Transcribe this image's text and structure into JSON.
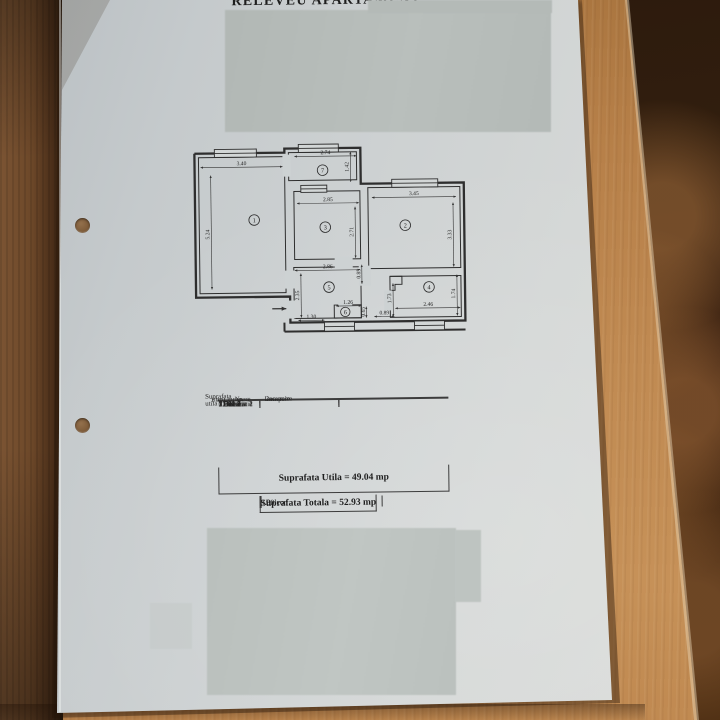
{
  "title": "RELEVEU APARTAMENT",
  "plan": {
    "rooms": {
      "r1": "1",
      "r2": "2",
      "r3": "3",
      "r4": "4",
      "r5": "5",
      "r6": "6",
      "r7": "7"
    },
    "dims": {
      "camera1_w": "3.40",
      "camera1_h": "5.24",
      "balcon_w": "2.74",
      "balcon_h": "1.42",
      "bucatarie_w": "2.85",
      "bucatarie_h": "2.71",
      "camera2_w": "3.45",
      "camera2_h": "3.33",
      "hol_w": "2.86",
      "hol_h": "2.35",
      "hol_door": "0.85",
      "debara_w": "1.26",
      "debara_h": "0.65",
      "debara_off": "1.30",
      "baie_door": "0.89",
      "baie_w": "2.46",
      "baie_hl": "1.73",
      "baie_hr": "1.74"
    }
  },
  "table": {
    "headers": {
      "col1_line1": "Nr.",
      "col1_line2": "incapere",
      "col2_line1": "Denumire",
      "col2_line2": "incapere",
      "col3_line1": "Suprafata utila",
      "col3_line2": "(mp)"
    },
    "rows": [
      {
        "nr": "1",
        "name": "Camera 1",
        "area": "17.81"
      },
      {
        "nr": "2",
        "name": "Camera 2",
        "area": "11.48"
      },
      {
        "nr": "3",
        "name": "Bucatarie",
        "area": "7.62"
      },
      {
        "nr": "4",
        "name": "Baie",
        "area": "3.98"
      },
      {
        "nr": "5",
        "name": "Hol",
        "area": "7.28"
      },
      {
        "nr": "6",
        "name": "Debara",
        "area": "0.87"
      }
    ],
    "utila_total": "Suprafata Utila = 49.04 mp",
    "balcon_label": "Balcon",
    "balcon_area": "3.89",
    "totala_total": "Suprafata Totala = 52.93 mp"
  },
  "colors": {
    "paper": "#cdd1d2",
    "redaction_grey": "#b7bdba",
    "wood_light": "#c08a52",
    "wood_dark": "#4a2e19",
    "carpet_dark": "#311e0e",
    "ink": "#242424"
  }
}
